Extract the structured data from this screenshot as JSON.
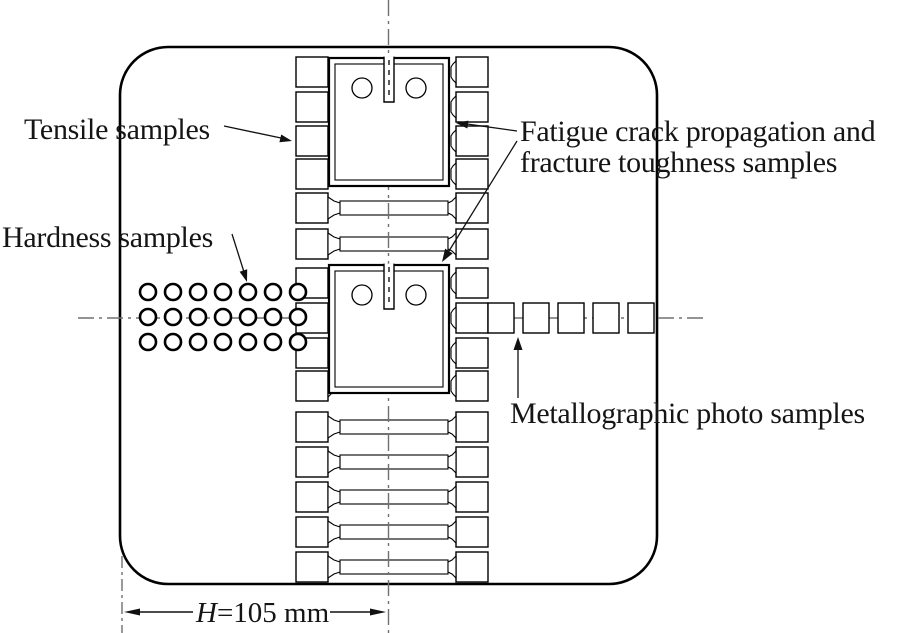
{
  "labels": {
    "tensile": "Tensile samples",
    "hardness": "Hardness samples",
    "fatigue_line1": "Fatigue crack propagation and",
    "fatigue_line2": "fracture toughness samples",
    "metallographic": "Metallographic photo samples"
  },
  "dimension": {
    "symbol": "H",
    "value": "=105 mm"
  },
  "samples": {
    "hardness": {
      "rows": 3,
      "cols": 7
    },
    "metallographic_count": 5,
    "fatigue_ct_count": 2,
    "tensile_grip_rows": 15,
    "dogbone_strip_rows": [
      5,
      6,
      11,
      12,
      13,
      14,
      15
    ]
  },
  "colors": {
    "line": "#000000",
    "centerline": "#707070",
    "text": "#151515",
    "background": "#ffffff"
  }
}
